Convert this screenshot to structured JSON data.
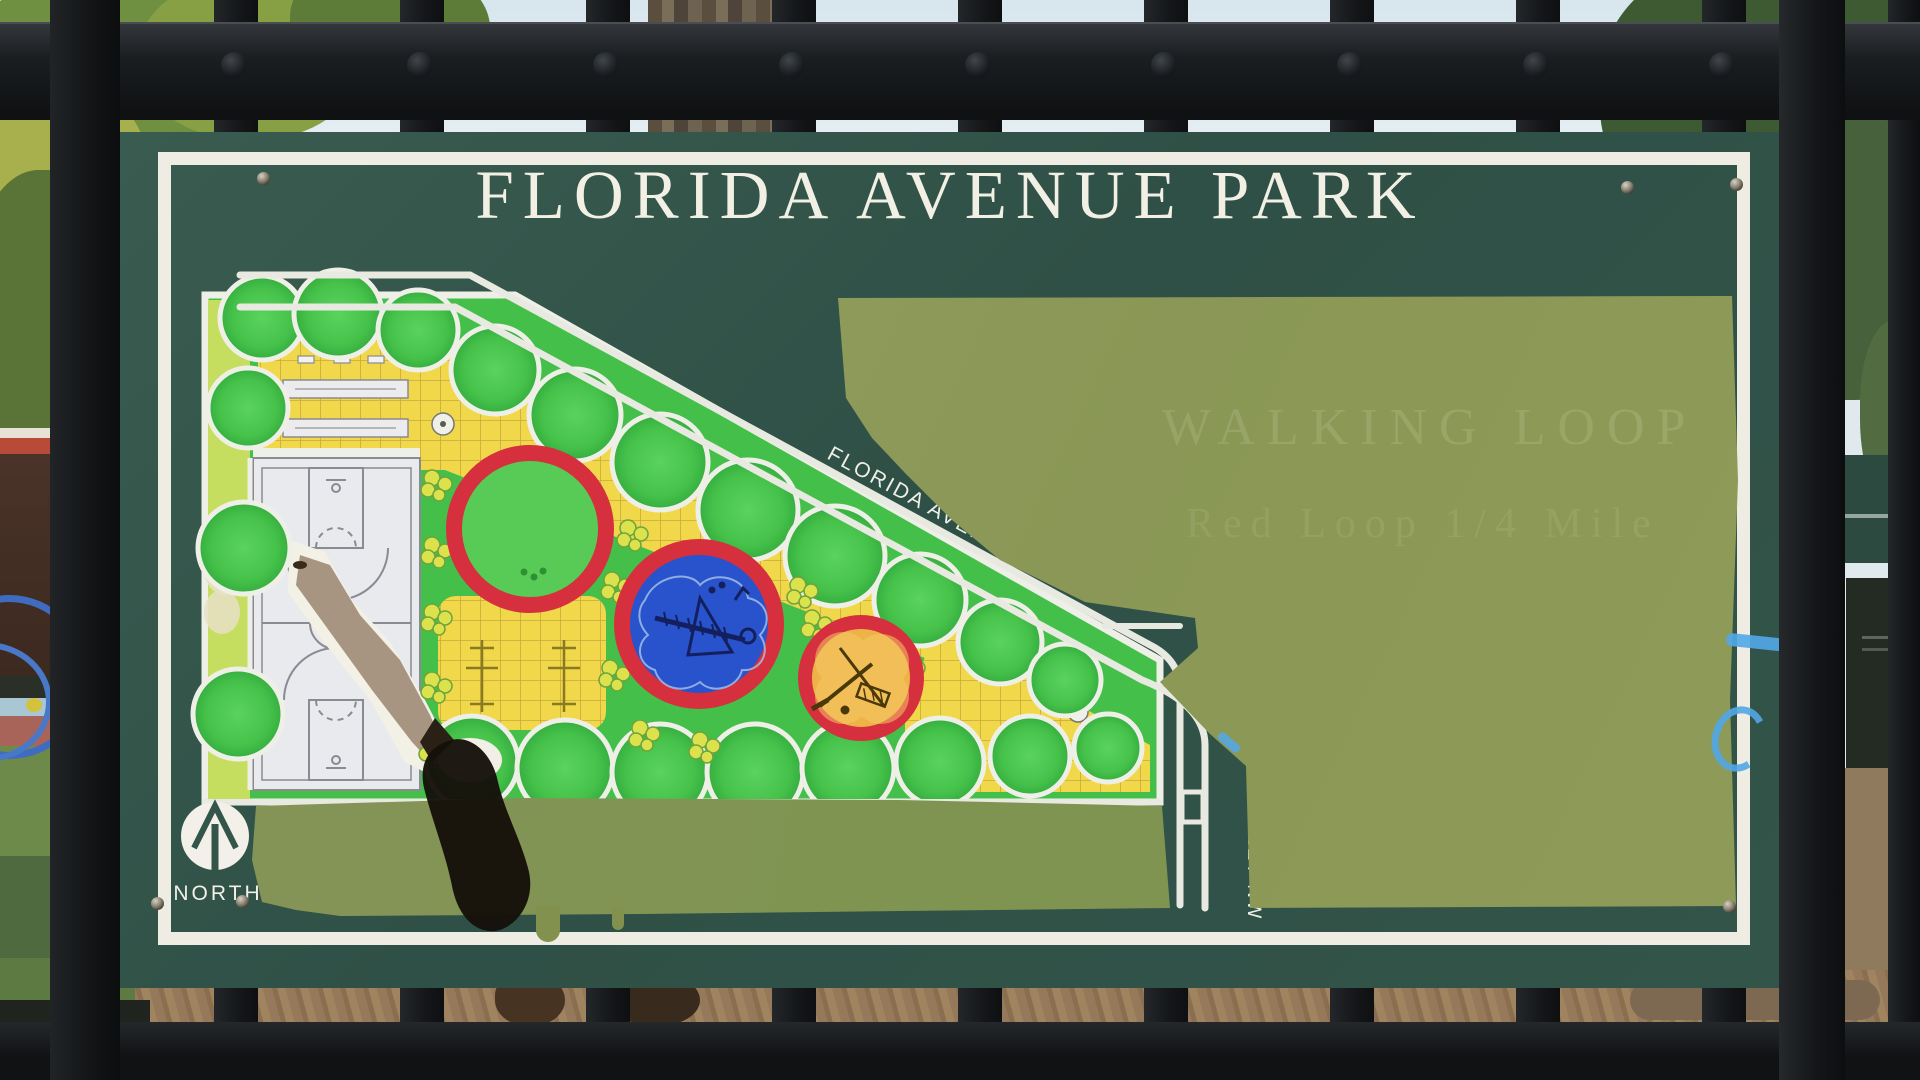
{
  "sign": {
    "title": "FLORIDA AVENUE PARK",
    "streets": {
      "florida_avenue": "FLORIDA AVENUE, NW",
      "first_street": "FIRST STREET NW"
    },
    "compass": {
      "label": "NORTH"
    },
    "ghost_overpaint_text": {
      "line1": "WALKING LOOP",
      "line2": "Red Loop    1/4 Mile"
    },
    "colors": {
      "panel_green": "#33554a",
      "overpaint_olive": "#8e9a5c",
      "frame_white": "#efece3",
      "ring_red": "#d62f3e",
      "playground_blue": "#2853cc",
      "playground_orange": "#edb348",
      "lawn_green": "#45c54b",
      "plaza_yellow": "#f0d84a",
      "marker_blue": "#52a8e8"
    }
  }
}
